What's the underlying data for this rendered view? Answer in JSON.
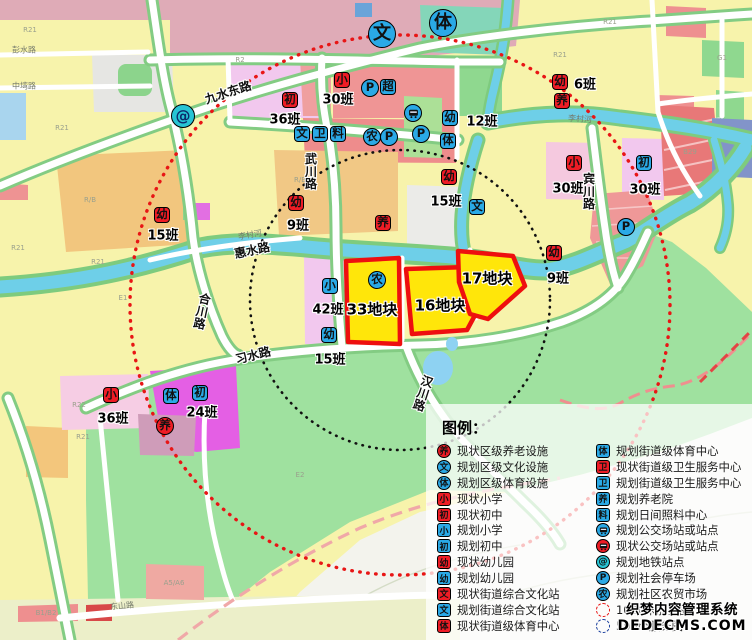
{
  "colors": {
    "icon_red": "#ee1c25",
    "icon_blue": "#2aa9e6",
    "metro_teal": "#27c4d4",
    "plot_fill": "#ffe60a",
    "plot_border": "#ee0f0f",
    "radius_1000_red": "#e81515",
    "radius_500_black": "#111111",
    "boundary_pink": "#f0a0a0"
  },
  "map": {
    "plots": [
      {
        "label": "33地块",
        "x": 372,
        "y": 309
      },
      {
        "label": "16地块",
        "x": 440,
        "y": 305
      },
      {
        "label": "17地块",
        "x": 487,
        "y": 278
      }
    ],
    "icons": [
      {
        "name": "district-culture-icon",
        "t": "bigc",
        "g": "文",
        "x": 382,
        "y": 34
      },
      {
        "name": "district-sports-icon",
        "t": "bigc",
        "g": "体",
        "x": 443,
        "y": 23
      },
      {
        "name": "metro-station-icon",
        "t": "metro",
        "g": "@",
        "x": 183,
        "y": 116
      },
      {
        "name": "existing-primary-school-icon",
        "t": "rs",
        "g": "小",
        "x": 342,
        "y": 80
      },
      {
        "name": "existing-middle-school-icon",
        "t": "rs",
        "g": "初",
        "x": 290,
        "y": 100
      },
      {
        "name": "parking-icon",
        "t": "bc",
        "g": "P",
        "x": 370,
        "y": 88
      },
      {
        "name": "supermarket-icon",
        "t": "bs",
        "g": "超",
        "x": 388,
        "y": 87
      },
      {
        "name": "bus-station-icon",
        "t": "bus",
        "g": "",
        "x": 413,
        "y": 113
      },
      {
        "name": "parking-icon",
        "t": "bc",
        "g": "P",
        "x": 421,
        "y": 134
      },
      {
        "name": "planned-kindergarten-icon",
        "t": "bs",
        "g": "幼",
        "x": 450,
        "y": 118
      },
      {
        "name": "planned-street-sports-icon",
        "t": "bs",
        "g": "体",
        "x": 448,
        "y": 141
      },
      {
        "name": "planned-culture-station-icon",
        "t": "bs",
        "g": "文",
        "x": 302,
        "y": 134
      },
      {
        "name": "planned-health-center-icon",
        "t": "bs",
        "g": "卫",
        "x": 320,
        "y": 134
      },
      {
        "name": "planned-daycare-icon",
        "t": "bs",
        "g": "料",
        "x": 338,
        "y": 134
      },
      {
        "name": "farmers-market-icon",
        "t": "bc",
        "g": "农",
        "x": 372,
        "y": 137
      },
      {
        "name": "parking-icon",
        "t": "bc",
        "g": "P",
        "x": 389,
        "y": 137
      },
      {
        "name": "existing-kindergarten-icon",
        "t": "rs",
        "g": "幼",
        "x": 296,
        "y": 203
      },
      {
        "name": "elderly-care-icon",
        "t": "rs",
        "g": "养",
        "x": 383,
        "y": 223
      },
      {
        "name": "existing-kindergarten-icon",
        "t": "rs",
        "g": "幼",
        "x": 449,
        "y": 177
      },
      {
        "name": "planned-culture-station-icon",
        "t": "bs",
        "g": "文",
        "x": 477,
        "y": 207
      },
      {
        "name": "existing-kindergarten-icon",
        "t": "rs",
        "g": "幼",
        "x": 162,
        "y": 215
      },
      {
        "name": "existing-kindergarten-icon",
        "t": "rs",
        "g": "幼",
        "x": 560,
        "y": 82
      },
      {
        "name": "elderly-care-icon",
        "t": "rs",
        "g": "养",
        "x": 562,
        "y": 101
      },
      {
        "name": "existing-primary-school-icon",
        "t": "rs",
        "g": "小",
        "x": 574,
        "y": 163
      },
      {
        "name": "planned-middle-school-icon",
        "t": "bs",
        "g": "初",
        "x": 644,
        "y": 163
      },
      {
        "name": "parking-icon",
        "t": "bc",
        "g": "P",
        "x": 626,
        "y": 227
      },
      {
        "name": "existing-kindergarten-icon",
        "t": "rs",
        "g": "幼",
        "x": 554,
        "y": 253
      },
      {
        "name": "planned-primary-school-icon",
        "t": "bs",
        "g": "小",
        "x": 330,
        "y": 286
      },
      {
        "name": "planned-kindergarten-icon",
        "t": "bs",
        "g": "幼",
        "x": 329,
        "y": 335
      },
      {
        "name": "farmers-market-icon",
        "t": "bc",
        "g": "农",
        "x": 377,
        "y": 280
      },
      {
        "name": "existing-primary-school-icon",
        "t": "rs",
        "g": "小",
        "x": 111,
        "y": 395
      },
      {
        "name": "planned-street-sports-icon",
        "t": "bs",
        "g": "体",
        "x": 171,
        "y": 396
      },
      {
        "name": "planned-middle-school-icon",
        "t": "bs",
        "g": "初",
        "x": 200,
        "y": 393
      },
      {
        "name": "district-elderly-care-icon",
        "t": "rc",
        "g": "养",
        "x": 165,
        "y": 426
      }
    ],
    "class_counts": [
      {
        "text": "30班",
        "x": 338,
        "y": 98
      },
      {
        "text": "36班",
        "x": 285,
        "y": 118
      },
      {
        "text": "12班",
        "x": 482,
        "y": 120
      },
      {
        "text": "9班",
        "x": 298,
        "y": 224
      },
      {
        "text": "15班",
        "x": 446,
        "y": 200
      },
      {
        "text": "15班",
        "x": 163,
        "y": 234
      },
      {
        "text": "6班",
        "x": 585,
        "y": 83
      },
      {
        "text": "30班",
        "x": 568,
        "y": 187
      },
      {
        "text": "30班",
        "x": 645,
        "y": 188
      },
      {
        "text": "9班",
        "x": 558,
        "y": 277
      },
      {
        "text": "42班",
        "x": 328,
        "y": 308
      },
      {
        "text": "15班",
        "x": 330,
        "y": 358
      },
      {
        "text": "36班",
        "x": 113,
        "y": 417
      },
      {
        "text": "24班",
        "x": 202,
        "y": 411
      }
    ],
    "road_labels": [
      {
        "text": "九水东路",
        "x": 228,
        "y": 92,
        "rot": -18
      },
      {
        "text": "惠水路",
        "x": 252,
        "y": 250,
        "rot": -12
      },
      {
        "text": "武川路",
        "x": 311,
        "y": 172,
        "vert": true,
        "rot": 0
      },
      {
        "text": "合川路",
        "x": 202,
        "y": 312,
        "vert": true,
        "rot": 12
      },
      {
        "text": "习水路",
        "x": 253,
        "y": 355,
        "rot": -14
      },
      {
        "text": "汉川路",
        "x": 423,
        "y": 394,
        "vert": true,
        "rot": 18
      },
      {
        "text": "宾川路",
        "x": 589,
        "y": 192,
        "vert": true,
        "rot": 0
      },
      {
        "text": "东山路",
        "x": 122,
        "y": 606,
        "rot": -5,
        "small": true
      },
      {
        "text": "彭水路",
        "x": 24,
        "y": 50,
        "rot": 0,
        "small": true
      },
      {
        "text": "中塆路",
        "x": 24,
        "y": 86,
        "rot": 0,
        "small": true
      },
      {
        "text": "李村河",
        "x": 250,
        "y": 235,
        "rot": -10,
        "small": true
      },
      {
        "text": "李村河",
        "x": 580,
        "y": 119,
        "rot": 4,
        "small": true
      }
    ],
    "parcel_codes": [
      {
        "text": "R21",
        "x": 30,
        "y": 30
      },
      {
        "text": "R21",
        "x": 62,
        "y": 128
      },
      {
        "text": "R21",
        "x": 18,
        "y": 248
      },
      {
        "text": "R21",
        "x": 98,
        "y": 262
      },
      {
        "text": "R21",
        "x": 560,
        "y": 55
      },
      {
        "text": "R21",
        "x": 610,
        "y": 22
      },
      {
        "text": "R21",
        "x": 83,
        "y": 437
      },
      {
        "text": "R22",
        "x": 79,
        "y": 405
      },
      {
        "text": "R2",
        "x": 240,
        "y": 60
      },
      {
        "text": "R/B",
        "x": 90,
        "y": 200
      },
      {
        "text": "R/B",
        "x": 300,
        "y": 180
      },
      {
        "text": "E1",
        "x": 123,
        "y": 298
      },
      {
        "text": "E2",
        "x": 300,
        "y": 475
      },
      {
        "text": "B1/B2",
        "x": 46,
        "y": 613
      },
      {
        "text": "A5/A6",
        "x": 174,
        "y": 583
      },
      {
        "text": "B29",
        "x": 690,
        "y": 152
      },
      {
        "text": "G1",
        "x": 722,
        "y": 58
      }
    ]
  },
  "legend": {
    "title": "图例：",
    "left": [
      {
        "shape": "ci",
        "color": "red",
        "g": "养",
        "label": "现状区级养老设施",
        "name": "legend-existing-district-elderly"
      },
      {
        "shape": "ci",
        "color": "blue",
        "g": "文",
        "label": "规划区级文化设施",
        "name": "legend-planned-district-culture"
      },
      {
        "shape": "ci",
        "color": "blue",
        "g": "体",
        "label": "规划区级体育设施",
        "name": "legend-planned-district-sports"
      },
      {
        "shape": "sq",
        "color": "red",
        "g": "小",
        "label": "现状小学",
        "name": "legend-existing-primary"
      },
      {
        "shape": "sq",
        "color": "red",
        "g": "初",
        "label": "现状初中",
        "name": "legend-existing-middle"
      },
      {
        "shape": "sq",
        "color": "blue",
        "g": "小",
        "label": "规划小学",
        "name": "legend-planned-primary"
      },
      {
        "shape": "sq",
        "color": "blue",
        "g": "初",
        "label": "规划初中",
        "name": "legend-planned-middle"
      },
      {
        "shape": "sq",
        "color": "red",
        "g": "幼",
        "label": "现状幼儿园",
        "name": "legend-existing-kindergarten"
      },
      {
        "shape": "sq",
        "color": "blue",
        "g": "幼",
        "label": "规划幼儿园",
        "name": "legend-planned-kindergarten"
      },
      {
        "shape": "sq",
        "color": "red",
        "g": "文",
        "label": "现状街道综合文化站",
        "name": "legend-existing-culture-station"
      },
      {
        "shape": "sq",
        "color": "blue",
        "g": "文",
        "label": "规划街道综合文化站",
        "name": "legend-planned-culture-station"
      },
      {
        "shape": "sq",
        "color": "red",
        "g": "体",
        "label": "现状街道级体育中心",
        "name": "legend-existing-street-sports"
      }
    ],
    "right": [
      {
        "shape": "sq",
        "color": "blue",
        "g": "体",
        "label": "规划街道级体育中心",
        "name": "legend-planned-street-sports"
      },
      {
        "shape": "sq",
        "color": "red",
        "g": "卫",
        "label": "现状街道级卫生服务中心",
        "name": "legend-existing-health-center"
      },
      {
        "shape": "sq",
        "color": "blue",
        "g": "卫",
        "label": "规划街道级卫生服务中心",
        "name": "legend-planned-health-center"
      },
      {
        "shape": "sq",
        "color": "blue",
        "g": "养",
        "label": "规划养老院",
        "name": "legend-planned-elderly-home"
      },
      {
        "shape": "sq",
        "color": "blue",
        "g": "料",
        "label": "规划日间照料中心",
        "name": "legend-planned-daycare"
      },
      {
        "shape": "ci",
        "color": "blue",
        "g": "BUS",
        "label": "规划公交场站或站点",
        "name": "legend-planned-bus"
      },
      {
        "shape": "ci",
        "color": "red",
        "g": "BUS",
        "label": "现状公交场站或站点",
        "name": "legend-existing-bus"
      },
      {
        "shape": "ci",
        "color": "teal",
        "g": "@",
        "label": "规划地铁站点",
        "name": "legend-planned-metro"
      },
      {
        "shape": "ci",
        "color": "blue",
        "g": "P",
        "label": "规划社会停车场",
        "name": "legend-planned-parking"
      },
      {
        "shape": "ci",
        "color": "blue",
        "g": "农",
        "label": "规划社区农贸市场",
        "name": "legend-planned-market"
      },
      {
        "shape": "dot-red",
        "color": "",
        "g": "",
        "label": "1000米服务圈",
        "name": "legend-1000m-radius"
      },
      {
        "shape": "dot-blue",
        "color": "",
        "g": "",
        "label": "500m服务圈",
        "name": "legend-500m-radius"
      }
    ]
  },
  "watermark": {
    "line1": "织梦内容管理系统",
    "line2": "DEDECMS.COM"
  }
}
